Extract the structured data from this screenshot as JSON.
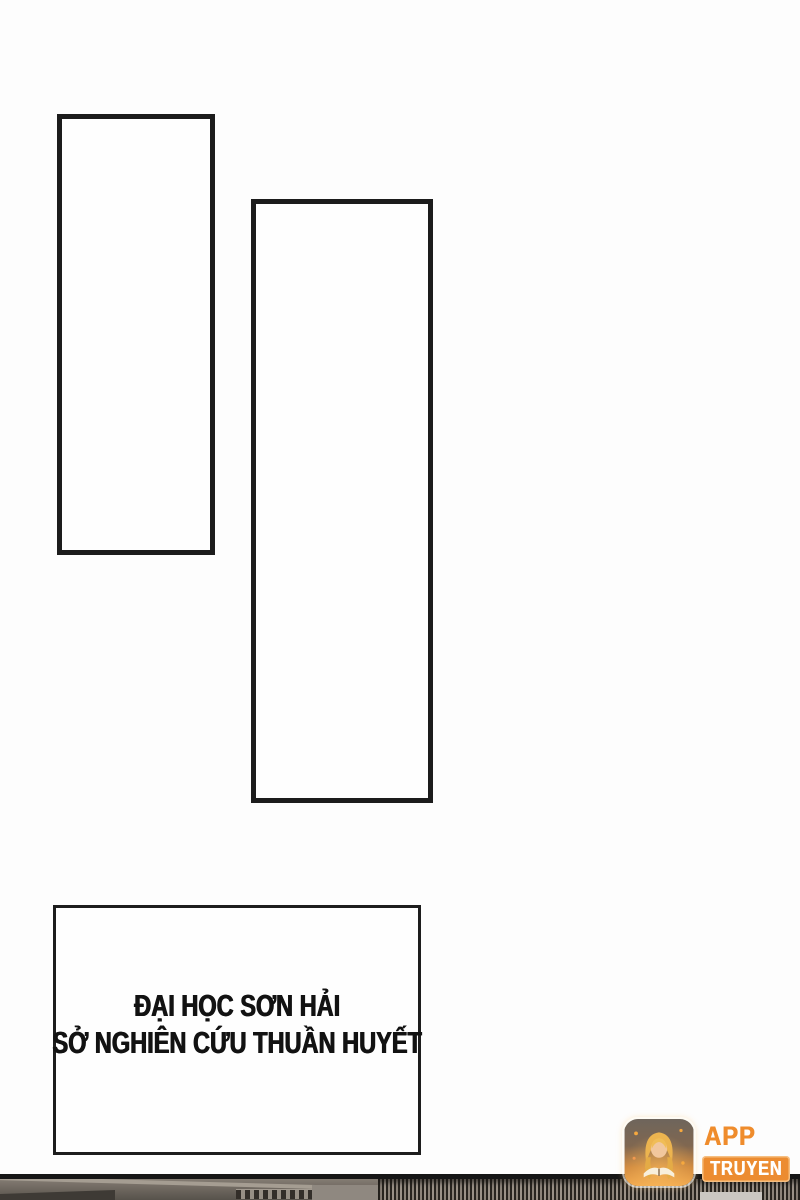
{
  "page": {
    "kind": "comic-page",
    "background": "#fdfdfd",
    "ink_color": "#1c1c1c"
  },
  "caption": {
    "lines": [
      "ĐẠI HỌC SƠN HẢI",
      "SỞ NGHIÊN CỨU THUẦN HUYẾT"
    ]
  },
  "watermark": {
    "app_label": "APP",
    "badge_label": "TRUYEN",
    "accent_color": "#ec8c31",
    "icon": "reading-girl-book-icon"
  }
}
